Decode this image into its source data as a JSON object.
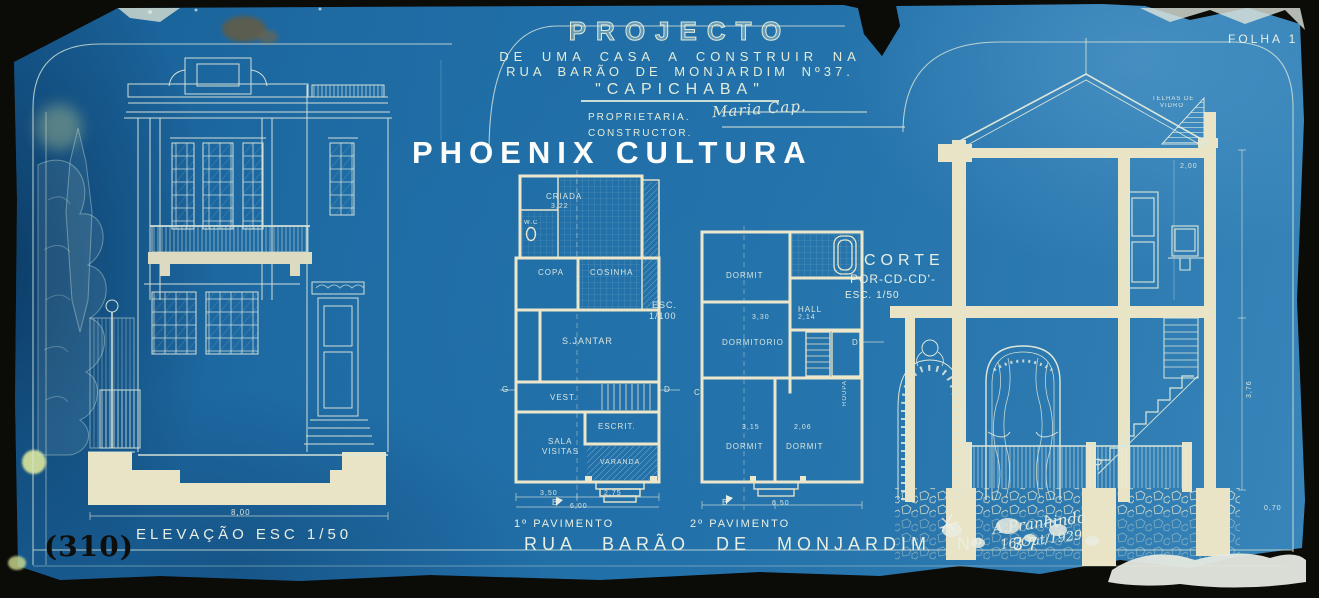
{
  "palette": {
    "paper_blue": "#2371aa",
    "line_cream": "#dde8da",
    "wall_cream": "#eae4c6",
    "border_black": "#0b0b08"
  },
  "meta": {
    "watermark": "PHOENIX CULTURA",
    "sheet_label": "FOLHA 1",
    "catalog_number": "(310)"
  },
  "title_block": {
    "line1": "PROJECTO",
    "line2": "DE UMA CASA A CONSTRUIR NA",
    "line3": "RUA BARÃO DE MONJARDIM Nº37.",
    "line4": "\"CAPICHABA\"",
    "proprietaria_label": "PROPRIETARIA.",
    "proprietaria_value": "Maria Cap.",
    "constructor_label": "CONSTRUCTOR."
  },
  "drawings": {
    "elevation": {
      "label": "ELEVAÇÃO   ESC 1/50",
      "width_dim": "8,00"
    },
    "plan1": {
      "label": "1º PAVIMENTO",
      "scale_line1": "ESC.",
      "scale_line2": "1/100"
    },
    "plan2": {
      "label": "2º PAVIMENTO"
    },
    "section": {
      "label_line1": "CORTE",
      "label_line2": "POR-CD-CD'-",
      "label_line3": "ESC. 1/50",
      "roof_note_line1": "TELHAS DE",
      "roof_note_line2": "VIDRO"
    }
  },
  "street_title": "RUA BARÃO DE MONJARDIM Nº 37",
  "signature": {
    "name": "A.Pranhindo",
    "date": "16/Out/1929"
  },
  "annotations": [
    {
      "name": "label-criada",
      "text": "CRIADA",
      "x": 546,
      "y": 192,
      "fs": 8
    },
    {
      "name": "dim-3-22",
      "text": "3,22",
      "x": 551,
      "y": 203,
      "fs": 7
    },
    {
      "name": "label-wc",
      "text": "W.C",
      "x": 524,
      "y": 220,
      "fs": 6
    },
    {
      "name": "label-copa",
      "text": "COPA",
      "x": 538,
      "y": 268,
      "fs": 8
    },
    {
      "name": "label-cosinha",
      "text": "COSINHA",
      "x": 590,
      "y": 268,
      "fs": 8
    },
    {
      "name": "label-sjantar",
      "text": "S.JANTAR",
      "x": 562,
      "y": 336,
      "fs": 9
    },
    {
      "name": "label-vest",
      "text": "VEST.",
      "x": 550,
      "y": 393,
      "fs": 8
    },
    {
      "name": "label-escrit",
      "text": "ESCRIT.",
      "x": 598,
      "y": 422,
      "fs": 8
    },
    {
      "name": "label-sala",
      "text": "SALA",
      "x": 548,
      "y": 437,
      "fs": 8
    },
    {
      "name": "label-visitas",
      "text": "VISITAS",
      "x": 542,
      "y": 447,
      "fs": 8
    },
    {
      "name": "label-varanda",
      "text": "VARANDA",
      "x": 600,
      "y": 459,
      "fs": 7
    },
    {
      "name": "dim-3-50",
      "text": "3,50",
      "x": 540,
      "y": 490,
      "fs": 7
    },
    {
      "name": "dim-2-75",
      "text": "2,75",
      "x": 604,
      "y": 490,
      "fs": 7
    },
    {
      "name": "dim-6-00",
      "text": "6,00",
      "x": 570,
      "y": 503,
      "fs": 7
    },
    {
      "name": "scale-esc",
      "text": "ESC.",
      "x": 652,
      "y": 300,
      "fs": 9
    },
    {
      "name": "scale-1-100",
      "text": "1/100",
      "x": 649,
      "y": 311,
      "fs": 9
    },
    {
      "name": "marker-g",
      "text": "G",
      "x": 502,
      "y": 385,
      "fs": 8
    },
    {
      "name": "marker-d",
      "text": "D",
      "x": 664,
      "y": 385,
      "fs": 8
    },
    {
      "name": "marker-c",
      "text": "C",
      "x": 694,
      "y": 388,
      "fs": 8
    },
    {
      "name": "marker-b",
      "text": "B",
      "x": 552,
      "y": 498,
      "fs": 8
    },
    {
      "name": "label-dormit-1",
      "text": "DORMIT",
      "x": 726,
      "y": 271,
      "fs": 8
    },
    {
      "name": "label-hall",
      "text": "HALL",
      "x": 798,
      "y": 305,
      "fs": 8
    },
    {
      "name": "label-dormitorio",
      "text": "DORMITORIO",
      "x": 722,
      "y": 338,
      "fs": 8
    },
    {
      "name": "dim-3-30",
      "text": "3,30",
      "x": 752,
      "y": 314,
      "fs": 7
    },
    {
      "name": "dim-2-14",
      "text": "2,14",
      "x": 798,
      "y": 314,
      "fs": 7
    },
    {
      "name": "label-dormit-2",
      "text": "DORMIT",
      "x": 726,
      "y": 442,
      "fs": 8
    },
    {
      "name": "label-dormit-3",
      "text": "DORMIT",
      "x": 786,
      "y": 442,
      "fs": 8
    },
    {
      "name": "dim-3-15",
      "text": "3,15",
      "x": 742,
      "y": 424,
      "fs": 7
    },
    {
      "name": "dim-2-06",
      "text": "2,06",
      "x": 794,
      "y": 424,
      "fs": 7
    },
    {
      "name": "label-roupa",
      "text": "ROUPA",
      "x": 842,
      "y": 406,
      "fs": 6,
      "rot": -90
    },
    {
      "name": "dim-6-50",
      "text": "6,50",
      "x": 772,
      "y": 500,
      "fs": 7
    },
    {
      "name": "marker-b2",
      "text": "B'",
      "x": 722,
      "y": 498,
      "fs": 8
    },
    {
      "name": "marker-d2",
      "text": "D'",
      "x": 852,
      "y": 338,
      "fs": 8
    },
    {
      "name": "dim-8-00",
      "text": "8,00",
      "x": 231,
      "y": 508,
      "fs": 8
    },
    {
      "name": "note-telhas-1",
      "text": "TELHAS DE",
      "x": 1152,
      "y": 96,
      "fs": 6
    },
    {
      "name": "note-telhas-2",
      "text": "VIDRO",
      "x": 1160,
      "y": 103,
      "fs": 6
    },
    {
      "name": "dim-2-00",
      "text": "2,00",
      "x": 1180,
      "y": 163,
      "fs": 7
    },
    {
      "name": "dim-3-76",
      "text": "3,76",
      "x": 1246,
      "y": 398,
      "fs": 7,
      "rot": -90
    },
    {
      "name": "dim-0-70",
      "text": "0,70",
      "x": 1264,
      "y": 505,
      "fs": 7
    }
  ]
}
